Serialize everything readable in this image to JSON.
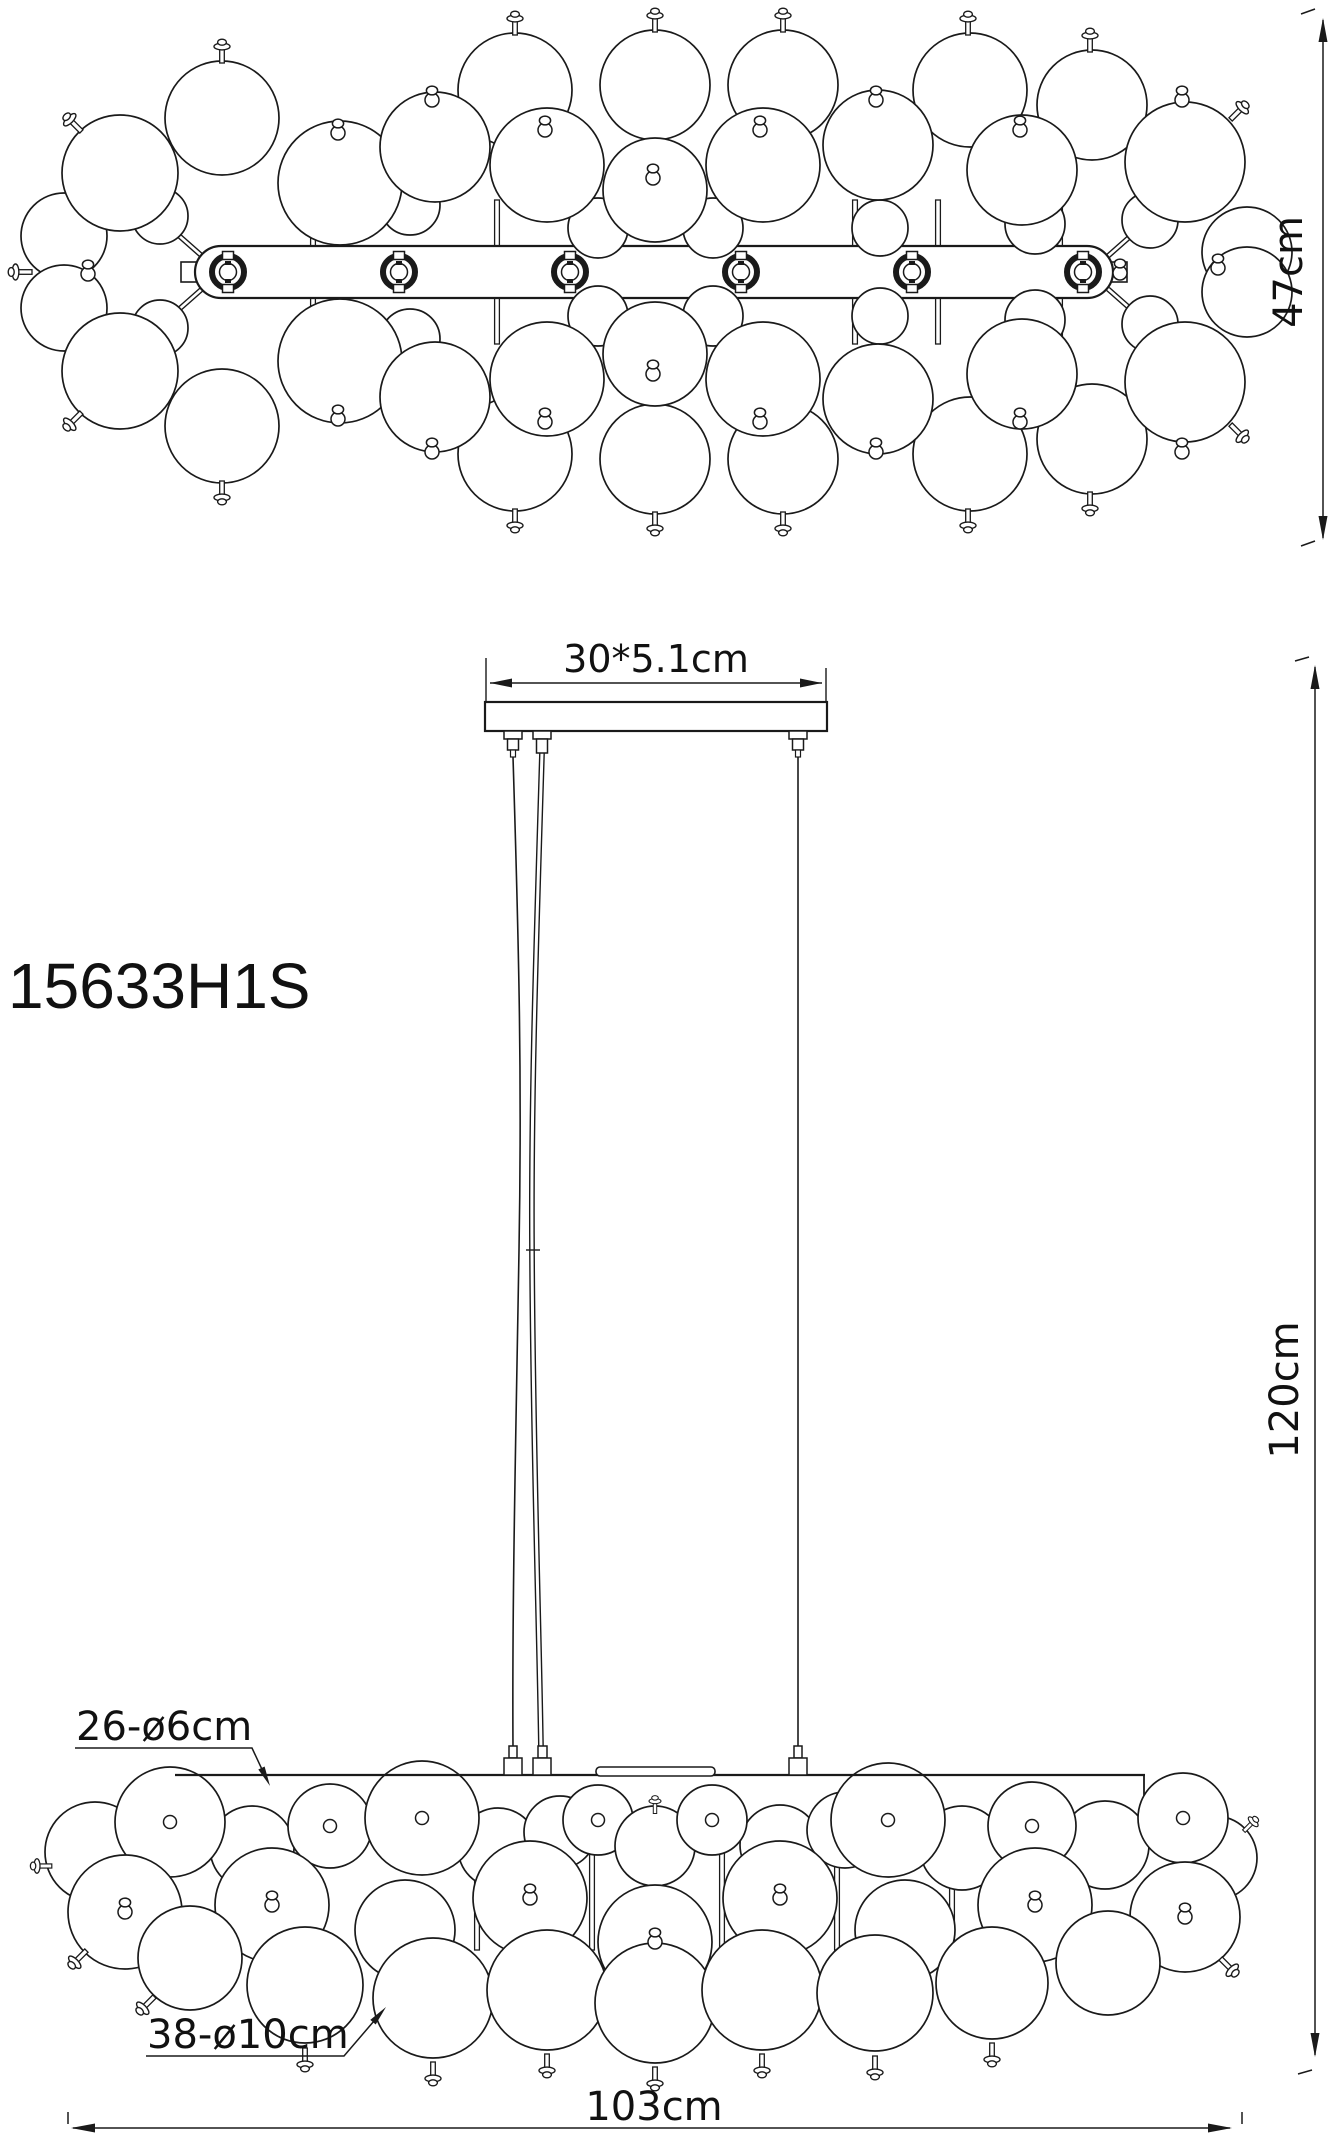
{
  "title": "Pendant chandelier technical drawing",
  "labels": {
    "model": "15633H1S"
  },
  "dimensions": {
    "fixture_height": "47cm",
    "canopy": "30*5.1cm",
    "drop_height": "120cm",
    "small_bubbles": "26-ø6cm",
    "large_bubbles": "38-ø10cm",
    "fixture_width": "103cm"
  },
  "colors": {
    "line": "#1a1a1a",
    "text": "#111111",
    "background": "#ffffff"
  }
}
